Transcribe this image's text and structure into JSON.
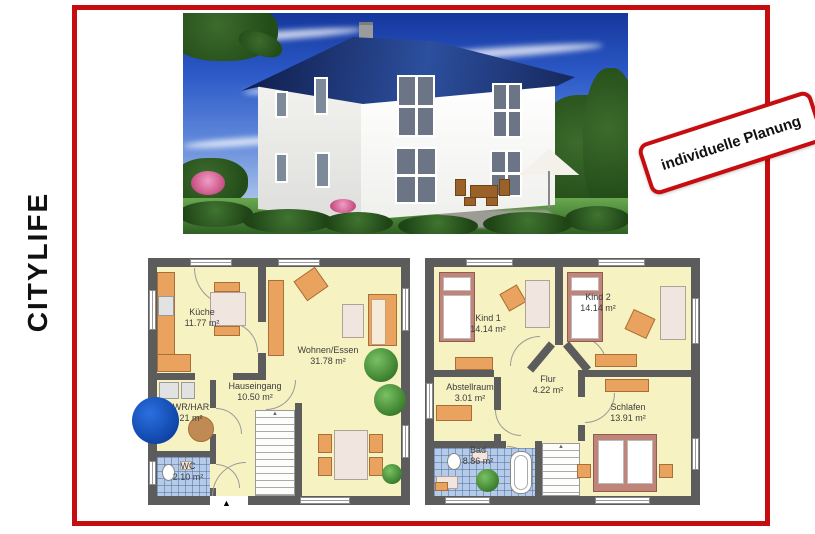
{
  "page": {
    "title_vertical": "CITYLIFE",
    "stamp_label": "individuelle Planung",
    "entrance_marker": "▲"
  },
  "colors": {
    "accent_red": "#c60d0f",
    "wall_gray": "#5c5c5c",
    "room_yellow": "#f7f2c2",
    "tile_blue": "#b5cbe7",
    "furniture_orange": "#e9a35f",
    "roof_blue": "#16275c",
    "logo_blue": "#0c3fa0"
  },
  "plans": {
    "ground": {
      "rooms": [
        {
          "name": "Küche",
          "area": "11.77 m²"
        },
        {
          "name": "Wohnen/Essen",
          "area": "31.78 m²"
        },
        {
          "name": "Hauseingang",
          "area": "10.50 m²"
        },
        {
          "name": "WR/HAR",
          "area": "21 m²"
        },
        {
          "name": "WC",
          "area": "2.10 m²"
        }
      ]
    },
    "upper": {
      "rooms": [
        {
          "name": "Kind 1",
          "area": "14.14 m²"
        },
        {
          "name": "Kind 2",
          "area": "14.14 m²"
        },
        {
          "name": "Abstellraum",
          "area": "3.01 m²"
        },
        {
          "name": "Flur",
          "area": "4.22 m²"
        },
        {
          "name": "Schlafen",
          "area": "13.91 m²"
        },
        {
          "name": "Bad",
          "area": "8.86 m²"
        }
      ]
    }
  }
}
